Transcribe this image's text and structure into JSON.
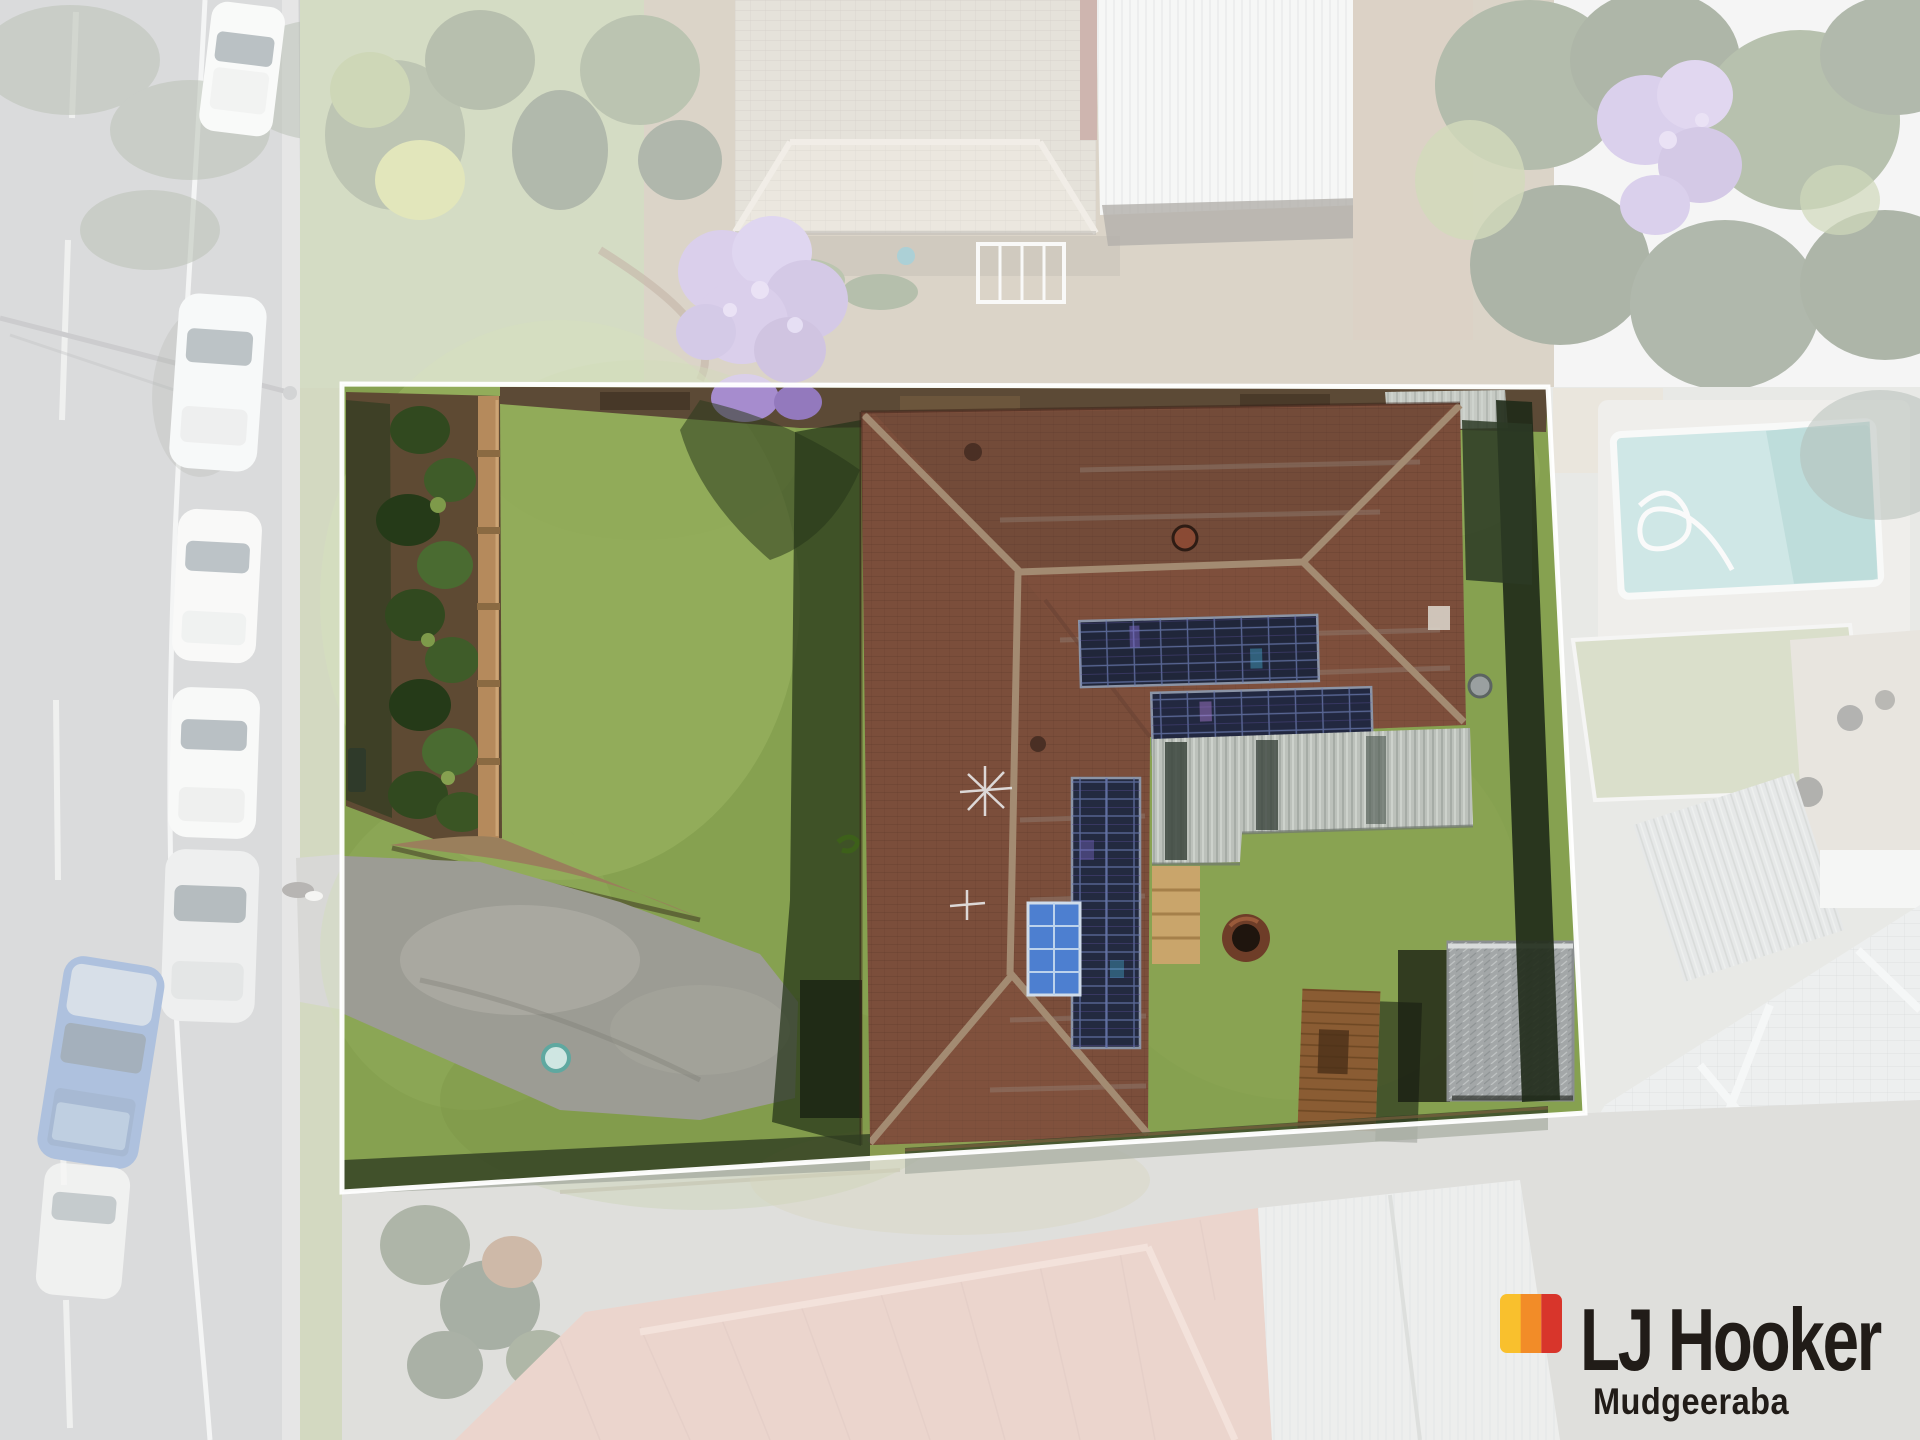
{
  "page": {
    "type": "aerial drone property photo",
    "width_px": 1920,
    "height_px": 1440
  },
  "logo": {
    "brand": "LJ Hooker",
    "office": "Mudgeeraba",
    "mark_colors": [
      "#f9c02d",
      "#f28c28",
      "#d8352b"
    ],
    "text_color": "#211c18"
  },
  "lot": {
    "outline_color": "#ffffff",
    "fade_color": "#ffffff",
    "fade_opacity": "0.58",
    "corners": "342,384 1548,387 1585,1113 342,1192",
    "fade_path": "M0,0 H1920 V1440 H0 Z M342,384 L1548,387 L1585,1113 L342,1192 Z"
  },
  "palette": {
    "lawn": "#86a150",
    "roof_tile": "#7b4e3b",
    "patio_roof": "#bcc1bb",
    "driveway": "#9c9c94",
    "pool_water": "#8ec7c4",
    "road": "#a7a9ab",
    "salmon_roof": "#cf9b89",
    "solar_panel": "#20263a",
    "garden_fence": "#b58a5c",
    "jacaranda": "#a78cd0",
    "gazebo_thatch": "#a3a7a8",
    "deck_timber": "#8a5c33"
  },
  "scene": {
    "street_side": "left",
    "parked_cars": 6,
    "solar_arrays": 4,
    "features": [
      "subject lot outlined in white over faded surroundings",
      "brown hip-roof house with rooftop solar panels",
      "front lawn, garden bed and timber fence",
      "driveway connecting to street",
      "rear patio roof, timber deck, fire pit, thatched gazebo",
      "neighbouring swimming pool at right",
      "jacaranda trees in bloom",
      "salmon tiled neighbour roof at bottom"
    ]
  }
}
